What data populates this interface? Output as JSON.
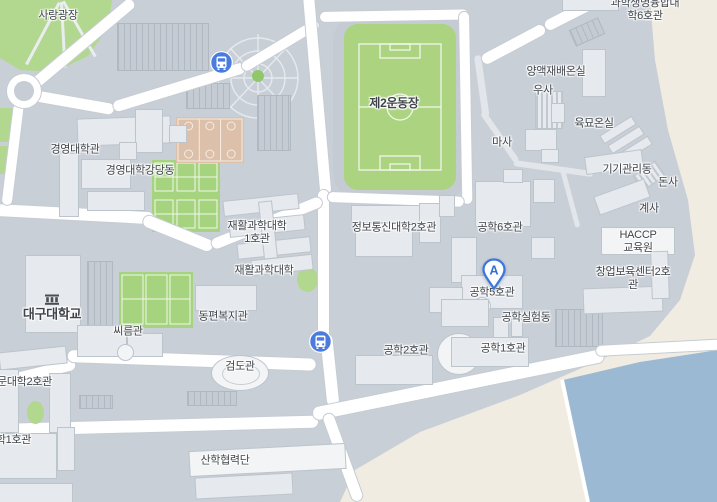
{
  "colors": {
    "bg": "#c9cfd7",
    "building": "#e6e9ed",
    "building_border": "#bcc4cc",
    "building_white": "#f3f4f6",
    "road": "#ffffff",
    "road_border": "#c6ccd3",
    "green_area": "#b2d78f",
    "field_green": "#abd380",
    "tennis_green": "#a6d37e",
    "court_line": "#f1f7ea",
    "basketball": "#dcc0aa",
    "water": "#9cb9d3",
    "bare_land": "#f1ece2",
    "parking": "#c4cbd3",
    "parking_lines": "#b0b8c2",
    "label": "#3f444b",
    "bus_blue": "#4a7ce0",
    "marker_blue": "#3a78e0",
    "plaza_green": "#8fc76a"
  },
  "marker": {
    "label": "A"
  },
  "icons": {
    "bus_stop": "bus-stop-icon",
    "school": "school-icon",
    "marker": "location-pin-A"
  },
  "labels": {
    "sarang_plaza": "사랑광장",
    "biz_hall": "경영대학관",
    "biz_auditorium": "경영대학강당동",
    "field2": "제2운동장",
    "sci6": "과학생명융합대학6호관",
    "nutrient_greenhouse": "양액재배온실",
    "cow_shed": "우사",
    "seedling_greenhouse": "육묘온실",
    "horse_stable": "마사",
    "equipment_bldg": "기기관리동",
    "pig_shed": "돈사",
    "chicken_shed": "계사",
    "haccp": "HACCP\n교육원",
    "incubator2": "창업보육센터2호관",
    "eng6": "공학6호관",
    "eng5": "공학5호관",
    "eng_lab": "공학실험동",
    "eng1": "공학1호관",
    "eng2": "공학2호관",
    "info2": "정보통신대학2호관",
    "rehab1": "재활과학대학\n1호관",
    "rehab": "재활과학대학",
    "east_welfare": "동편복지관",
    "ssireum": "씨름관",
    "kendo": "검도관",
    "daegu_univ": "대구대학교",
    "humanities2": "문대학2호관",
    "bldg1_partial": "대학1호관",
    "sanhak": "산학협력단"
  }
}
